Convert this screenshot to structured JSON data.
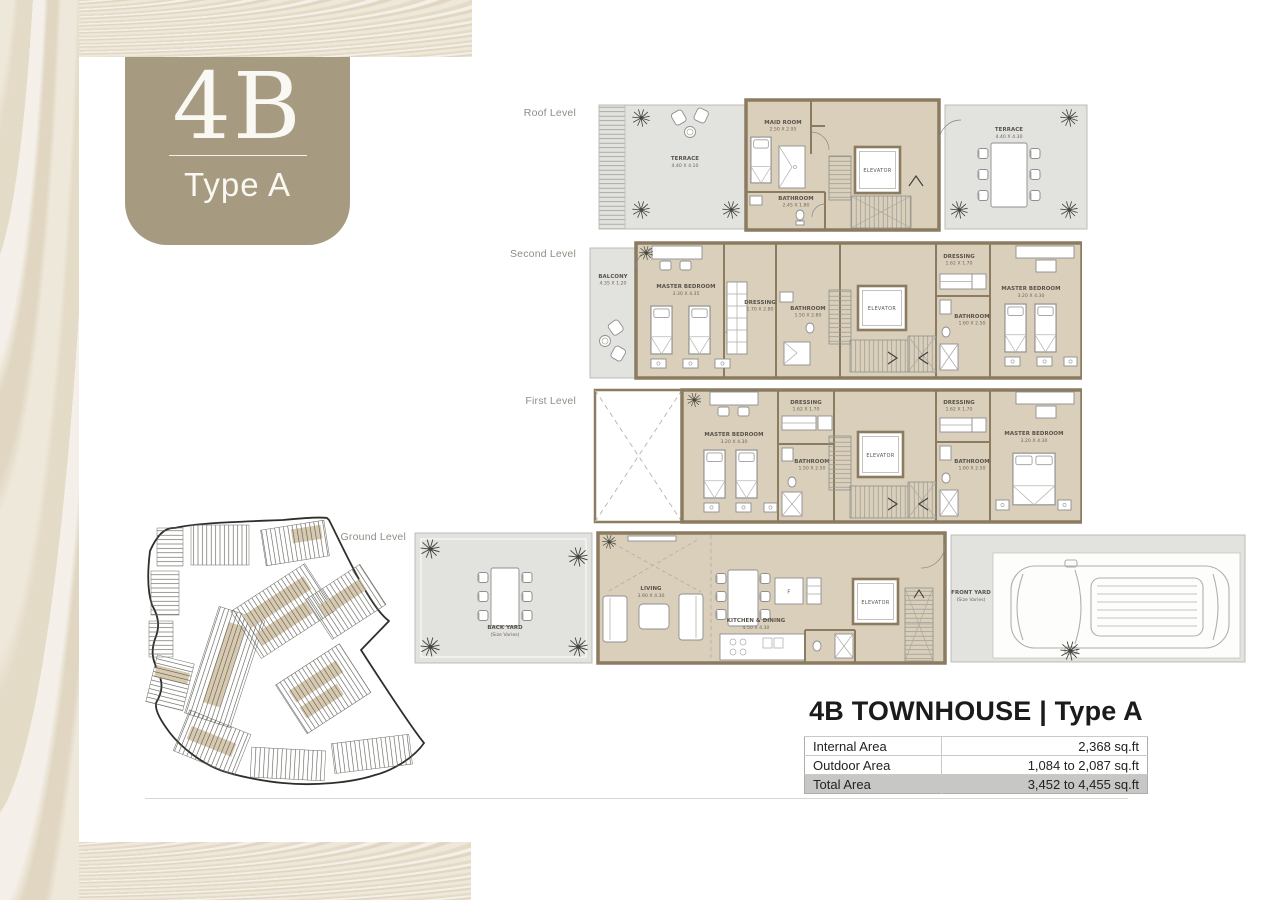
{
  "badge": {
    "code": "4B",
    "type_label": "Type A"
  },
  "levels": [
    {
      "name": "Roof Level",
      "rooms": [
        {
          "name": "TERRACE",
          "dims": "4.40 X 4.10"
        },
        {
          "name": "MAID ROOM",
          "dims": "2.50 X 2.95"
        },
        {
          "name": "BATHROOM",
          "dims": "2.45 X 1.80"
        },
        {
          "name": "ELEVATOR",
          "dims": ""
        },
        {
          "name": "TERRACE",
          "dims": "4.40 X 4.30"
        }
      ]
    },
    {
      "name": "Second Level",
      "rooms": [
        {
          "name": "BALCONY",
          "dims": "4.35 X 1.20"
        },
        {
          "name": "MASTER BEDROOM",
          "dims": "3.30 X 4.35"
        },
        {
          "name": "DRESSING",
          "dims": "1.70 X 2.80"
        },
        {
          "name": "BATHROOM",
          "dims": "1.50 X 2.80"
        },
        {
          "name": "ELEVATOR",
          "dims": ""
        },
        {
          "name": "DRESSING",
          "dims": "1.62 X 1.70"
        },
        {
          "name": "BATHROOM",
          "dims": "1.60 X 2.50"
        },
        {
          "name": "MASTER BEDROOM",
          "dims": "3.20 X 4.30"
        }
      ]
    },
    {
      "name": "First Level",
      "rooms": [
        {
          "name": "MASTER BEDROOM",
          "dims": "3.20 X 4.30"
        },
        {
          "name": "DRESSING",
          "dims": "1.62 X 1.70"
        },
        {
          "name": "BATHROOM",
          "dims": "1.50 X 2.50"
        },
        {
          "name": "ELEVATOR",
          "dims": ""
        },
        {
          "name": "DRESSING",
          "dims": "1.62 X 1.70"
        },
        {
          "name": "BATHROOM",
          "dims": "1.60 X 2.50"
        },
        {
          "name": "MASTER BEDROOM",
          "dims": "3.20 X 4.30"
        }
      ]
    },
    {
      "name": "Ground Level",
      "rooms": [
        {
          "name": "BACK YARD",
          "dims": "(Size Varies)"
        },
        {
          "name": "LIVING",
          "dims": "3.90 X 4.30"
        },
        {
          "name": "KITCHEN & DINING",
          "dims": "4.50 X 4.30"
        },
        {
          "name": "ELEVATOR",
          "dims": ""
        },
        {
          "name": "FRONT YARD",
          "dims": "(Size Varies)"
        }
      ],
      "misc": {
        "fridge_label": "F"
      }
    }
  ],
  "summary": {
    "title": "4B TOWNHOUSE | Type A",
    "rows": [
      {
        "label": "Internal Area",
        "value": "2,368 sq.ft"
      },
      {
        "label": "Outdoor Area",
        "value": "1,084 to 2,087 sq.ft"
      },
      {
        "label": "Total Area",
        "value": "3,452 to 4,455 sq.ft"
      }
    ]
  },
  "colors": {
    "badge": "#a69a81",
    "wall": "#8b7b60",
    "floor": "#dacfba",
    "outdoor": "#e2e2de",
    "texture": "#e7dfce",
    "total_row": "#c7c7c5"
  }
}
